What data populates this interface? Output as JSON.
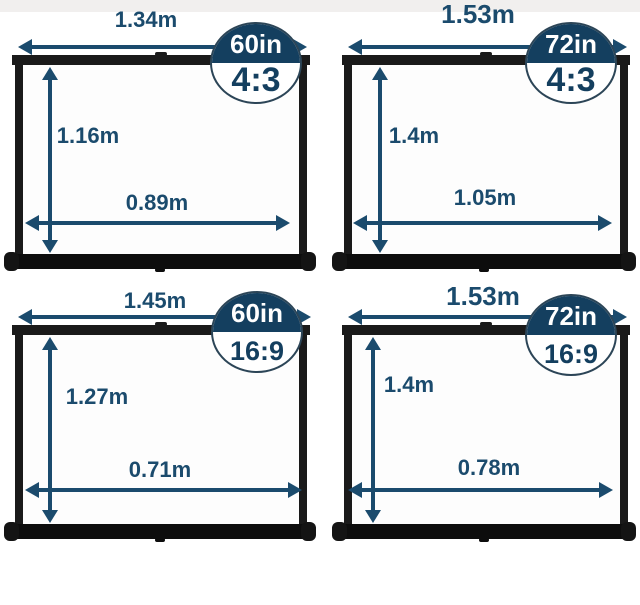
{
  "colors": {
    "accent_navy": "#1b4b6d",
    "badge_navy": "#143f5f",
    "frame_black": "#1a1a1a"
  },
  "panels": [
    {
      "size": "60in",
      "ratio": "4:3",
      "total_width": "1.34m",
      "screen_height": "1.16m",
      "viewing_width": "0.89m"
    },
    {
      "size": "72in",
      "ratio": "4:3",
      "total_width": "1.53m",
      "screen_height": "1.4m",
      "viewing_width": "1.05m"
    },
    {
      "size": "60in",
      "ratio": "16:9",
      "total_width": "1.45m",
      "screen_height": "1.27m",
      "viewing_width": "0.71m"
    },
    {
      "size": "72in",
      "ratio": "16:9",
      "total_width": "1.53m",
      "screen_height": "1.4m",
      "viewing_width": "0.78m"
    }
  ]
}
